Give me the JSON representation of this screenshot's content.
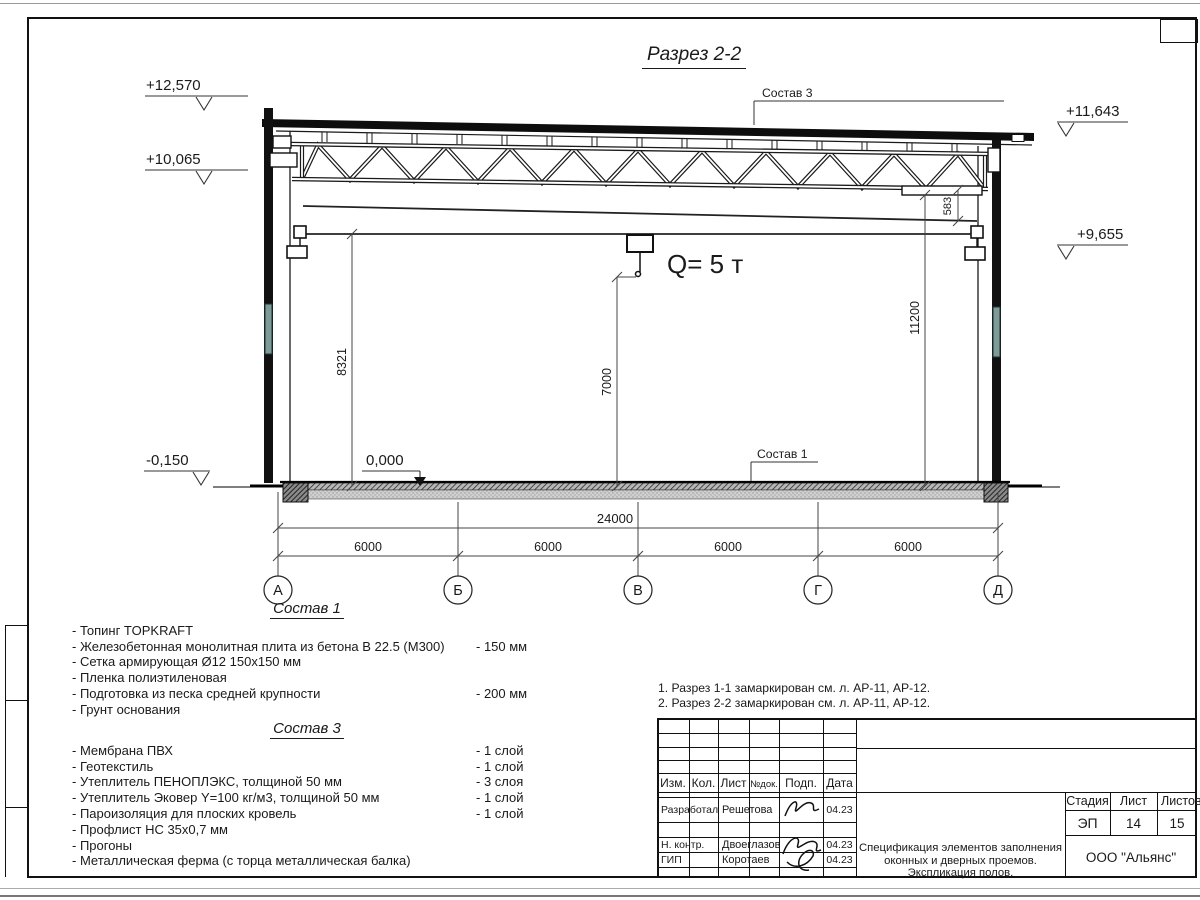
{
  "sheet": {
    "title": "Разрез 2-2",
    "notes": [
      "1. Разрез 1-1 замаркирован см. л. АР-11, АР-12.",
      "2. Разрез 2-2 замаркирован см. л. АР-11, АР-12."
    ]
  },
  "drawing": {
    "crane_label": "Q= 5 т",
    "elevations": {
      "parapet": "+12,570",
      "truss_bottom": "+10,065",
      "right_top": "+11,643",
      "right_low": "+9,655",
      "floor_zero": "0,000",
      "ground": "-0,150"
    },
    "dims": {
      "crane_height": "8321",
      "hook_height": "7000",
      "clear_height": "11200",
      "truss_depth": "583",
      "total_span": "24000",
      "bay1": "6000",
      "bay2": "6000",
      "bay3": "6000",
      "bay4": "6000"
    },
    "axes": {
      "a": "А",
      "b": "Б",
      "v": "В",
      "g": "Г",
      "d": "Д"
    },
    "callouts": {
      "floor": "Состав 1",
      "roof": "Состав 3"
    }
  },
  "sostav1": {
    "heading": "Состав 1",
    "items": [
      {
        "t": "- Топинг TOPKRAFT",
        "v": ""
      },
      {
        "t": "- Железобетонная  монолитная плита из бетона  В 22.5 (М300)",
        "v": "- 150 мм"
      },
      {
        "t": "- Сетка армирующая Ø12 150х150 мм",
        "v": ""
      },
      {
        "t": "- Пленка полиэтиленовая",
        "v": ""
      },
      {
        "t": "- Подготовка из песка средней  крупности",
        "v": "- 200 мм"
      },
      {
        "t": "- Грунт основания",
        "v": ""
      }
    ]
  },
  "sostav3": {
    "heading": "Состав 3",
    "items": [
      {
        "t": "- Мембрана ПВХ",
        "v": "- 1 слой"
      },
      {
        "t": "- Геотекстиль",
        "v": "- 1 слой"
      },
      {
        "t": "- Утеплитель ПЕНОПЛЭКС, толщиной 50 мм",
        "v": "- 3 слоя"
      },
      {
        "t": "- Утеплитель Эковер Y=100 кг/м3, толщиной 50 мм",
        "v": "- 1 слой"
      },
      {
        "t": "- Пароизоляция для плоских кровель",
        "v": "- 1 слой"
      },
      {
        "t": "- Профлист НС 35х0,7 мм",
        "v": ""
      },
      {
        "t": "- Прогоны",
        "v": ""
      },
      {
        "t": "- Металлическая ферма (с торца металлическая балка)",
        "v": ""
      }
    ]
  },
  "titleblock": {
    "cols": {
      "izm": "Изм.",
      "kol": "Кол.",
      "list": "Лист",
      "ndoc": "№док.",
      "podp": "Подп.",
      "data": "Дата"
    },
    "rows": [
      {
        "role": "Разработал",
        "name": "Решетова",
        "date": "04.23"
      },
      {
        "role": "Н. контр.",
        "name": "Двоеглазов",
        "date": "04.23"
      },
      {
        "role": "ГИП",
        "name": "Коротаев",
        "date": "04.23"
      }
    ],
    "stage_label": "Стадия",
    "sheet_label": "Лист",
    "sheets_label": "Листов",
    "stage": "ЭП",
    "sheet_no": "14",
    "sheets_total": "15",
    "doc_name_lines": [
      "Спецификация элементов заполнения",
      "оконных и дверных проемов.",
      "Экспликация полов."
    ],
    "company": "ООО \"Альянс\""
  }
}
